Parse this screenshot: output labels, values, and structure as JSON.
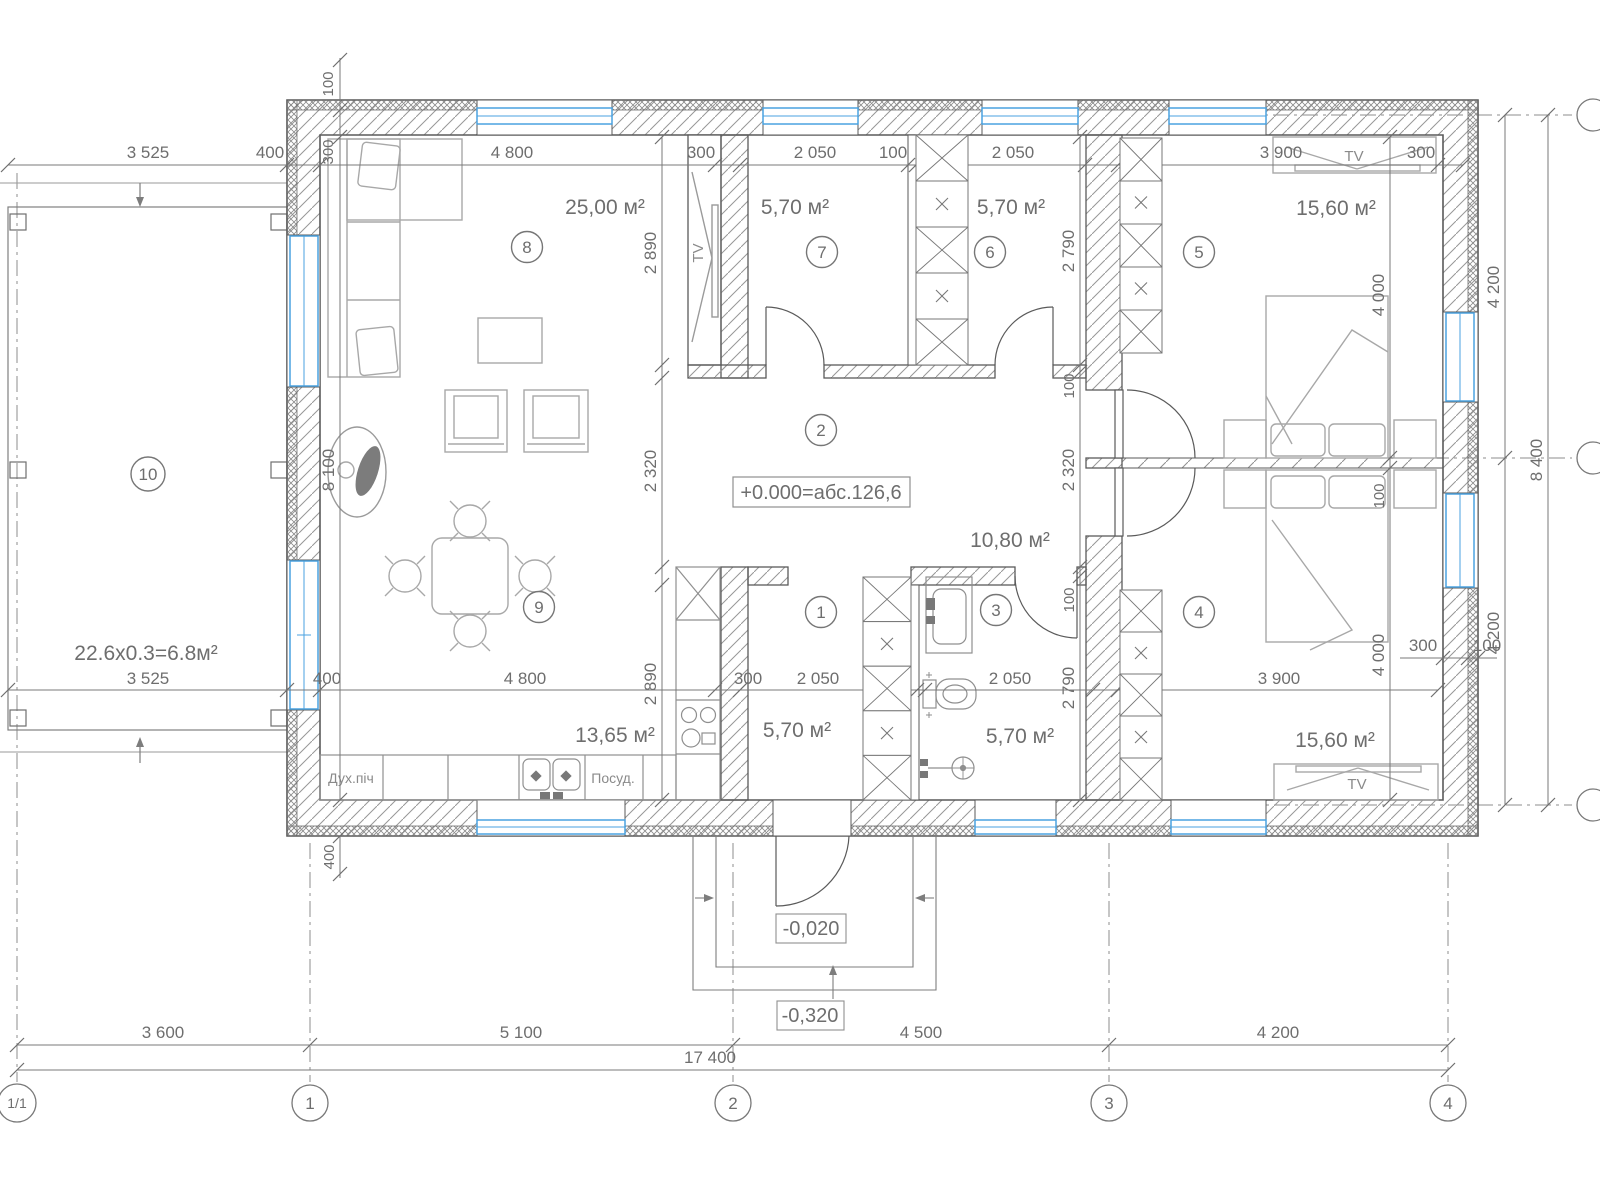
{
  "rooms": [
    {
      "num": "1",
      "area": "5,70 м²"
    },
    {
      "num": "2",
      "area": "10,80 м²"
    },
    {
      "num": "3",
      "area": "5,70 м²"
    },
    {
      "num": "4",
      "area": "15,60 м²"
    },
    {
      "num": "5",
      "area": "15,60 м²"
    },
    {
      "num": "6",
      "area": "5,70 м²"
    },
    {
      "num": "7",
      "area": "5,70 м²"
    },
    {
      "num": "8",
      "area": "25,00 м²"
    },
    {
      "num": "9",
      "area": "13,65 м²"
    },
    {
      "num": "10",
      "area": "22.6x0.3=6.8м²"
    }
  ],
  "levels": {
    "zero": "+0.000=абс.126,6",
    "entry": "-0,020",
    "ground": "-0,320"
  },
  "axes": {
    "bottom": [
      "1/1",
      "1",
      "2",
      "3",
      "4"
    ]
  },
  "dims": {
    "top": [
      "3 525",
      "400",
      "4 800",
      "300",
      "2 050",
      "100",
      "2 050",
      "300",
      "3 900",
      "300"
    ],
    "top_left_vertical": [
      "100",
      "300"
    ],
    "mid": [
      "3 525",
      "400",
      "4 800",
      "300",
      "2 050",
      "100",
      "2 050",
      "300",
      "3 900",
      "300",
      "100"
    ],
    "left_inner": [
      "2 890",
      "2 320",
      "2 890"
    ],
    "left_wall": [
      "8 100",
      "400"
    ],
    "right_inner": [
      "2 790",
      "100",
      "2 320",
      "100",
      "2 790"
    ],
    "bedroom_inner": [
      "4 000",
      "100",
      "4 000"
    ],
    "right_outer": [
      "4 200",
      "8 400",
      "4 200"
    ],
    "bottom": [
      "3 600",
      "5 100",
      "4 500",
      "4 200"
    ],
    "bottom_total": "17 400"
  },
  "labels": {
    "tv": "TV",
    "oven": "Дух.піч",
    "dishwasher": "Посуд."
  },
  "colors": {
    "window": "#4aa2e0",
    "wall_line": "#5a5a5a",
    "dim_line": "#787878",
    "furniture": "#a8a8a8"
  }
}
